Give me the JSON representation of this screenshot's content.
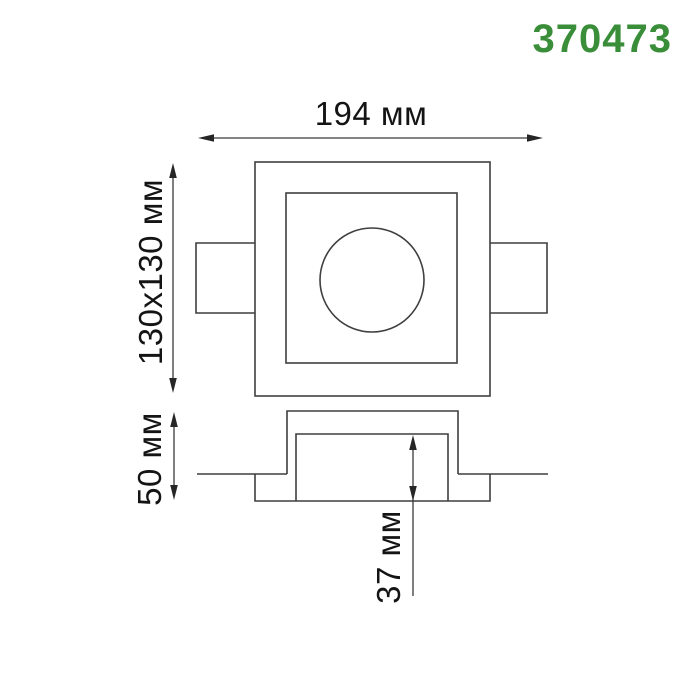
{
  "product_number": "370473",
  "accent_color": "#3a8e3a",
  "labels": {
    "width": "194 мм",
    "cutout": "130x130 мм",
    "height": "50 мм",
    "recess_depth": "37 мм"
  }
}
